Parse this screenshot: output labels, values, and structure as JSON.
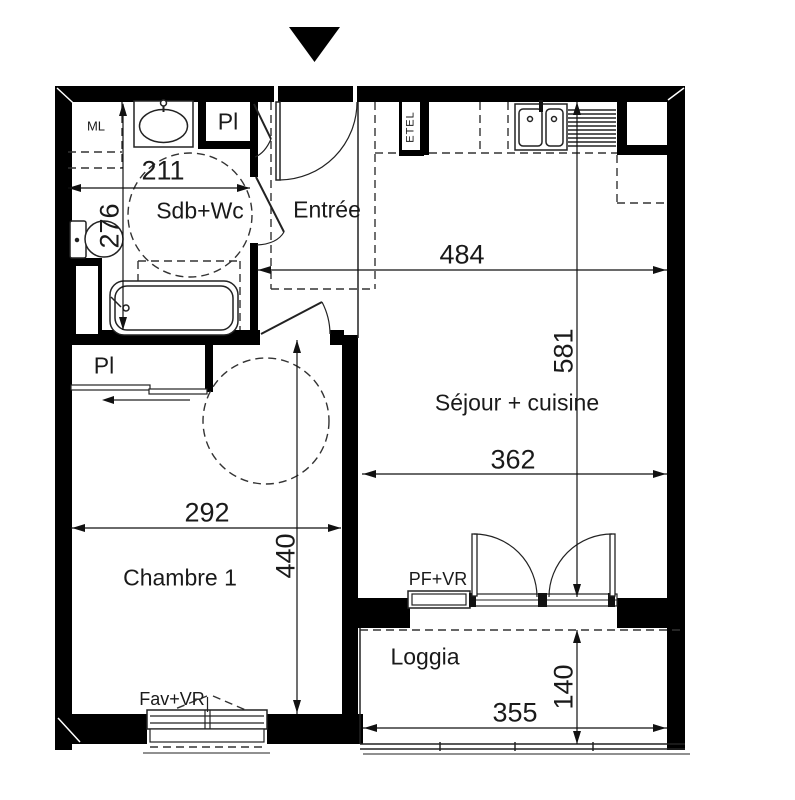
{
  "plan": {
    "rooms": {
      "sdb": {
        "label": "Sdb+Wc"
      },
      "entree": {
        "label": "Entrée"
      },
      "sejour": {
        "label": "Séjour + cuisine"
      },
      "chambre1": {
        "label": "Chambre 1"
      },
      "loggia": {
        "label": "Loggia"
      }
    },
    "annotations": {
      "ml": {
        "label": "ML"
      },
      "pl_sdb": {
        "label": "Pl"
      },
      "pl_chambre": {
        "label": "Pl"
      },
      "etel": {
        "label": "ETEL"
      },
      "pf_vr": {
        "label": "PF+VR"
      },
      "fav_vr": {
        "label": "Fav+VR"
      }
    },
    "dimensions_cm": {
      "sdb_width": "211",
      "sdb_height": "276",
      "entree_sejour_width": "484",
      "sejour_height": "581",
      "sejour_width": "362",
      "chambre_width": "292",
      "chambre_height": "440",
      "loggia_depth": "140",
      "loggia_width": "355"
    },
    "colors": {
      "wall": "#000000",
      "line": "#222222",
      "dashed": "#333333",
      "text": "#1a1a1a",
      "background": "#ffffff"
    }
  }
}
